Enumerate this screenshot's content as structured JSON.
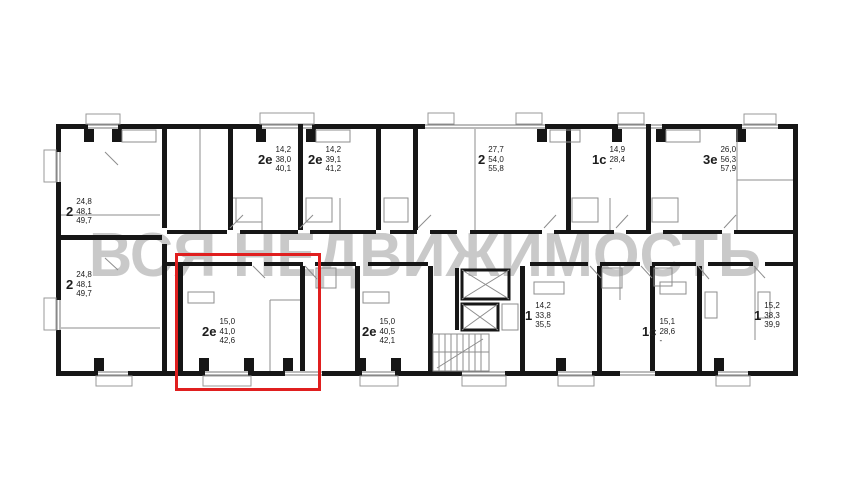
{
  "watermark": {
    "text": "ВСЯ НЕДВИЖИМОСТЬ"
  },
  "highlight": {
    "color": "#e01f1f"
  },
  "apartments": [
    {
      "type": "2",
      "area_room": "24,8",
      "area_living": "48,1",
      "area_total": "49,7"
    },
    {
      "type": "2",
      "area_room": "24,8",
      "area_living": "48,1",
      "area_total": "49,7"
    },
    {
      "type": "2е",
      "area_room": "14,2",
      "area_living": "38,0",
      "area_total": "40,1"
    },
    {
      "type": "2е",
      "area_room": "14,2",
      "area_living": "39,1",
      "area_total": "41,2"
    },
    {
      "type": "2",
      "area_room": "27,7",
      "area_living": "54,0",
      "area_total": "55,8"
    },
    {
      "type": "1с",
      "area_room": "14,9",
      "area_living": "28,4",
      "area_total": "-"
    },
    {
      "type": "3е",
      "area_room": "26,0",
      "area_living": "56,3",
      "area_total": "57,9"
    },
    {
      "type": "2е",
      "area_room": "15,0",
      "area_living": "41,0",
      "area_total": "42,6"
    },
    {
      "type": "2е",
      "area_room": "15,0",
      "area_living": "40,5",
      "area_total": "42,1"
    },
    {
      "type": "1",
      "area_room": "14,2",
      "area_living": "33,8",
      "area_total": "35,5"
    },
    {
      "type": "1с",
      "area_room": "15,1",
      "area_living": "28,6",
      "area_total": "-"
    },
    {
      "type": "1",
      "area_room": "15,2",
      "area_living": "38,3",
      "area_total": "39,9"
    }
  ]
}
